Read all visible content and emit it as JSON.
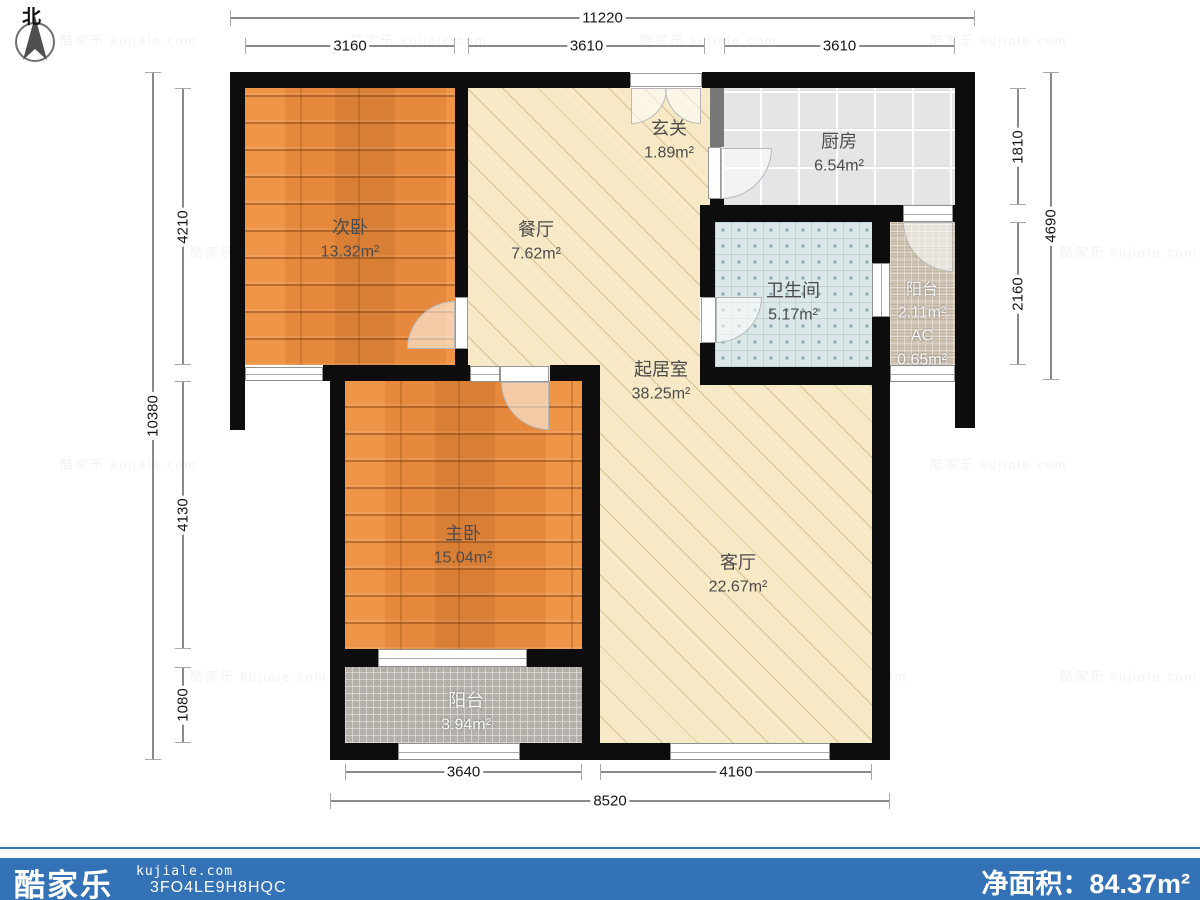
{
  "north": {
    "label": "北"
  },
  "rooms": {
    "secondary_bedroom": {
      "name": "次卧",
      "area": "13.32m²"
    },
    "dining": {
      "name": "餐厅",
      "area": "7.62m²"
    },
    "entry": {
      "name": "玄关",
      "area": "1.89m²"
    },
    "kitchen": {
      "name": "厨房",
      "area": "6.54m²"
    },
    "bathroom": {
      "name": "卫生间",
      "area": "5.17m²"
    },
    "balcony_right": {
      "name": "阳台",
      "area": "2.11m²",
      "ac_label": "AC",
      "ac_area": "0.65m²"
    },
    "living_core": {
      "name": "起居室",
      "area": "38.25m²"
    },
    "master_bedroom": {
      "name": "主卧",
      "area": "15.04m²"
    },
    "living_room": {
      "name": "客厅",
      "area": "22.67m²"
    },
    "balcony_bottom": {
      "name": "阳台",
      "area": "3.94m²"
    }
  },
  "dimensions": {
    "top_total": "11220",
    "top_seg1": "3160",
    "top_seg2": "3610",
    "top_seg3": "3610",
    "left_total": "10380",
    "left_seg1": "4210",
    "left_seg2": "4130",
    "left_seg3": "1080",
    "right_total": "4690",
    "right_seg1": "1810",
    "right_seg2": "2160",
    "bottom_total": "8520",
    "bottom_seg1": "3640",
    "bottom_seg2": "4160"
  },
  "footer": {
    "brand": "酷家乐",
    "site": "kujiale.com",
    "code": "3FO4LE9H8HQC",
    "net_area": "净面积：84.37m²"
  },
  "watermark": {
    "text": "酷家乐 kujiale.com"
  },
  "colors": {
    "footer_blue": "#3372b7",
    "wall": "#0d0d0d",
    "wood": "#e6893c",
    "cream": "#f7e9c5",
    "kitchen_gray": "#e5e5e7",
    "bath_blue": "#dbe7e9",
    "tan_mosaic": "#cfc3b1",
    "gray_mosaic": "#b8b4ad"
  }
}
